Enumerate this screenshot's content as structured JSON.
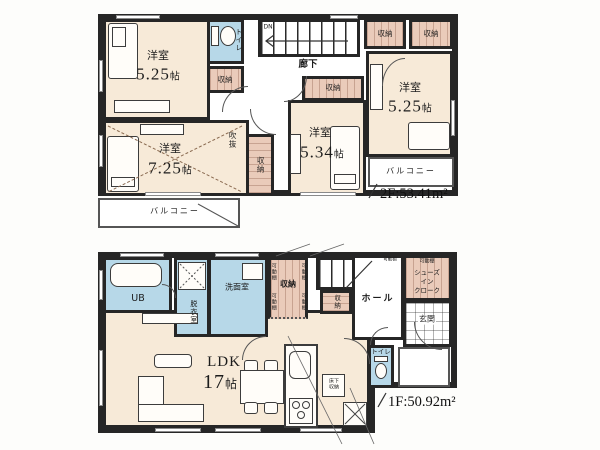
{
  "meta": {
    "floor2_area": "2F:53.41m²",
    "floor1_area": "1F:50.92m²"
  },
  "f2": {
    "rooms": [
      {
        "name": "洋室",
        "num": "5.25",
        "unit": "帖"
      },
      {
        "name": "洋室",
        "num": "7.25",
        "unit": "帖"
      },
      {
        "name": "洋室",
        "num": "5.34",
        "unit": "帖"
      },
      {
        "name": "洋室",
        "num": "5.25",
        "unit": "帖"
      }
    ],
    "labels": {
      "hallway": "廊下",
      "stairs_dn": "DN",
      "void": "吹抜",
      "toilet": "トイレ",
      "closet": "収納",
      "balcony": "バルコニー"
    }
  },
  "f1": {
    "ldk": {
      "name": "LDK",
      "num": "17",
      "unit": "帖"
    },
    "labels": {
      "ub": "UB",
      "dressing": "脱衣室",
      "washroom": "洗面室",
      "closet": "収納",
      "shelf": "可動棚",
      "hall": "ホール",
      "toilet": "トイレ",
      "entrance": "玄関",
      "underfloor": "床下収納",
      "shoes_line1": "シューズ",
      "shoes_line2": "イン",
      "shoes_line3": "クローク"
    }
  }
}
